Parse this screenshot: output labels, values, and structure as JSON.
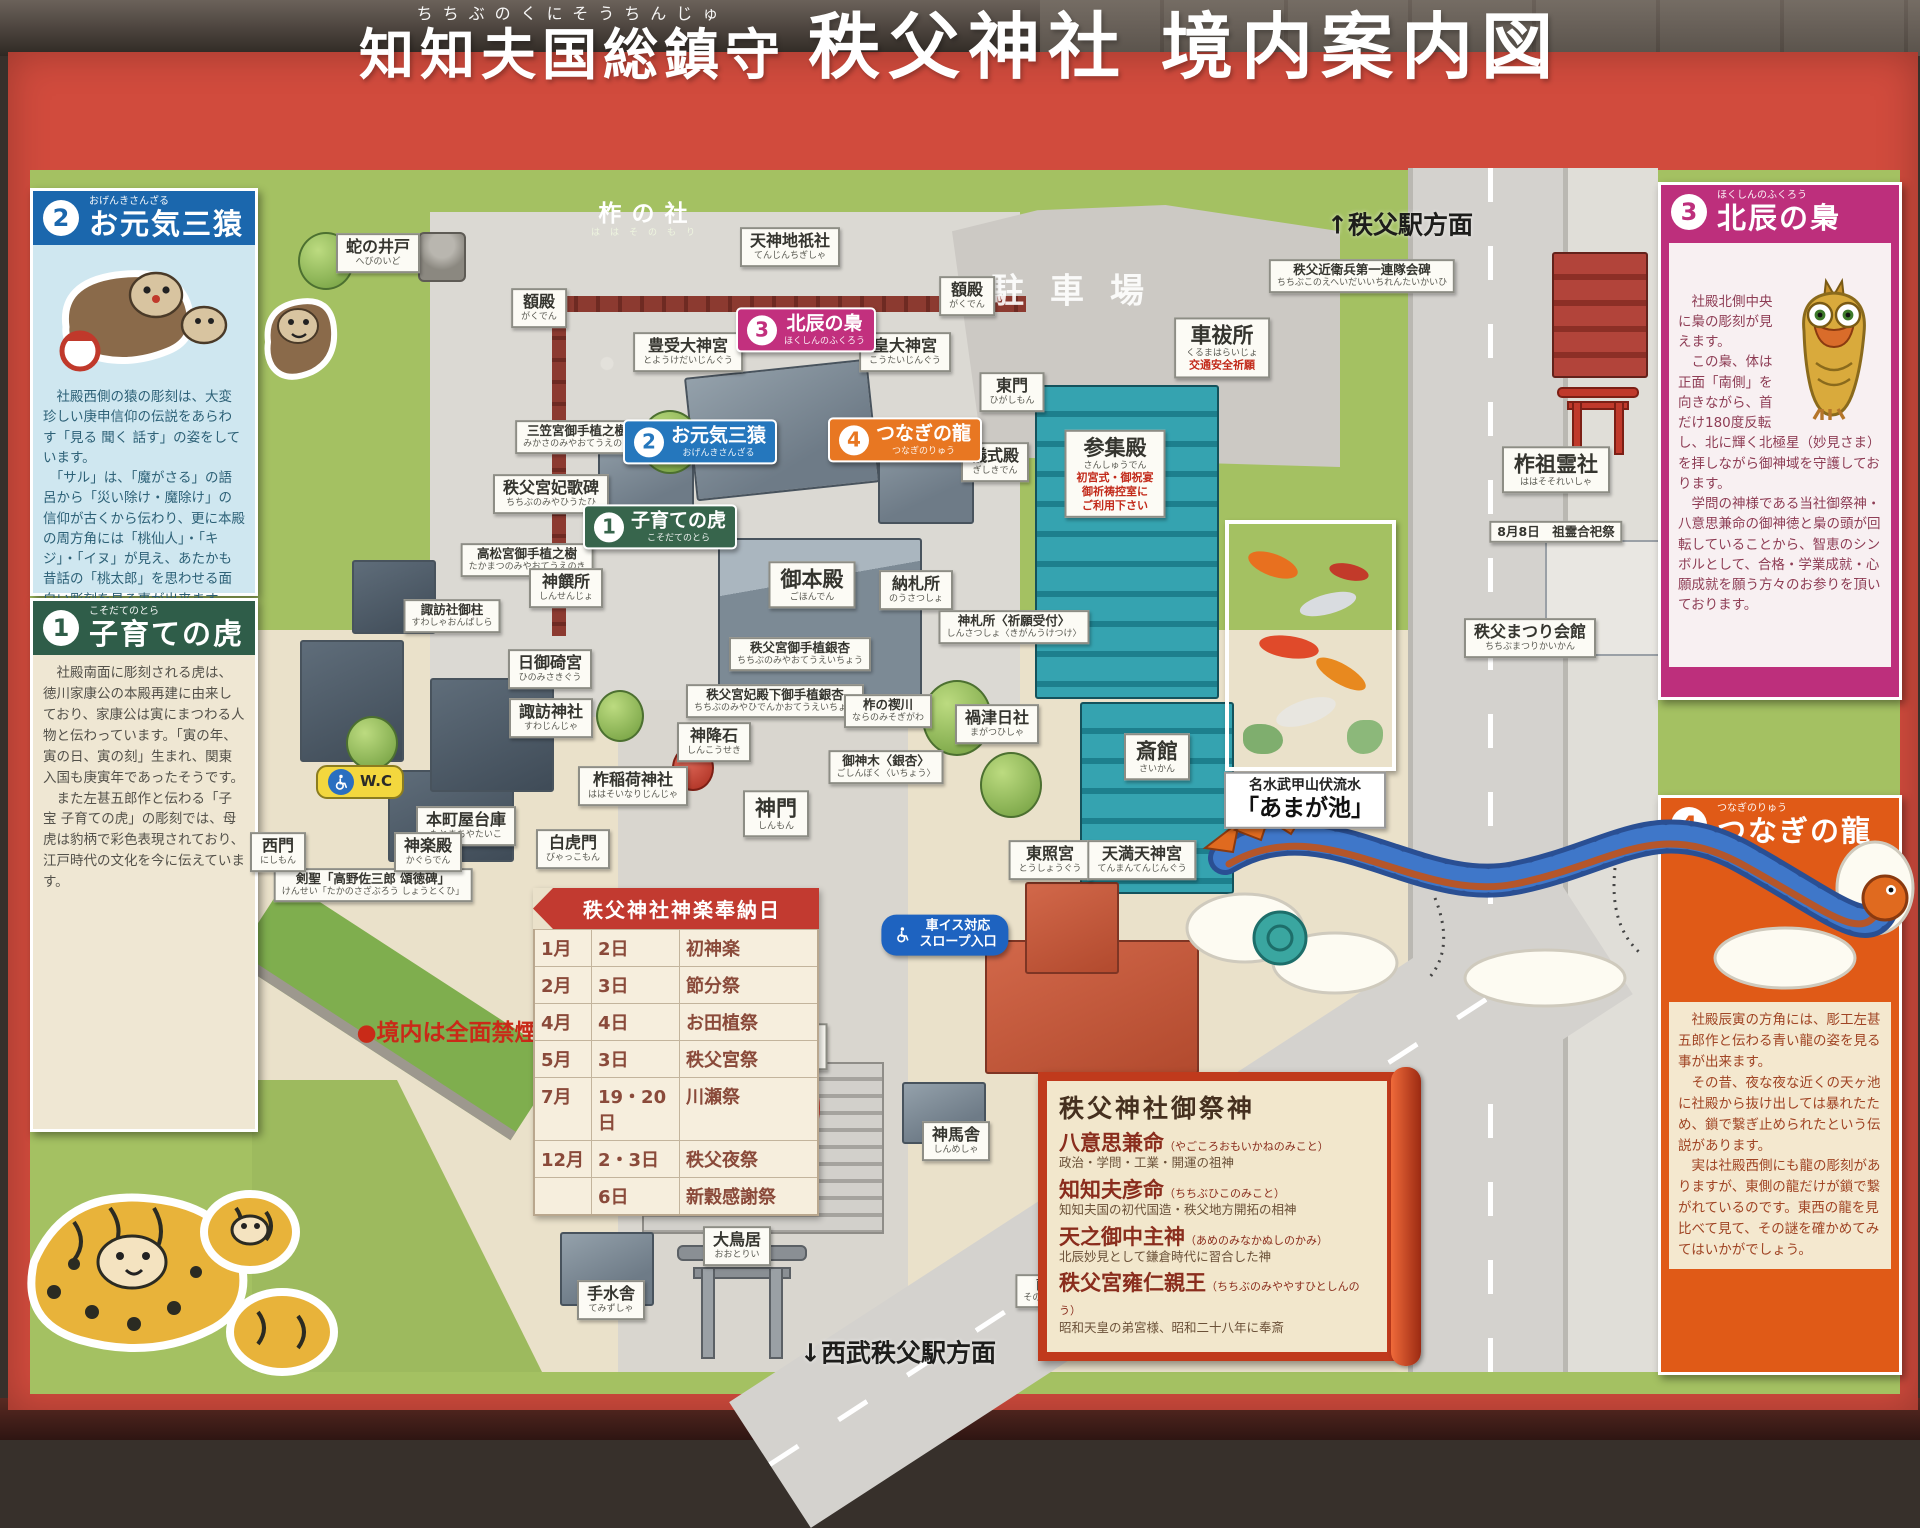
{
  "title": {
    "ruby_base": "知知夫国総鎮守",
    "ruby_text": "ちちぶのくにそうちんじゅ",
    "main": "秩父神社 境内案内図"
  },
  "panels": {
    "sanzaru": {
      "num": "2",
      "name": "お元気三猿",
      "ruby": "おげんきさんざる",
      "body": "　社殿西側の猿の彫刻は、大変珍しい庚申信仰の伝説をあらわす「見る 聞く 話す」の姿をしています。\n　「サル」は、「魔がさる」の語呂から「災い除け・魔除け」の信仰が古くから伝わり、更に本殿の周方角には「桃仙人」・「キジ」・「イヌ」が見え、あたかも昔話の「桃太郎」を思わせる面白い彫刻を見る事が出来ます。"
    },
    "tora": {
      "num": "1",
      "name": "子育ての虎",
      "ruby": "こそだてのとら",
      "body": "　社殿南面に彫刻される虎は、徳川家康公の本殿再建に由来しており、家康公は寅にまつわる人物と伝わっています。「寅の年、寅の日、寅の刻」生まれ、関東入国も庚寅年であったそうです。\n　また左甚五郎作と伝わる「子宝 子育ての虎」の彫刻では、母虎は豹柄で彩色表現されており、江戸時代の文化を今に伝えています。"
    },
    "fukurou": {
      "num": "3",
      "name": "北辰の梟",
      "ruby": "ほくしんのふくろう",
      "body": "　社殿北側中央に梟の彫刻が見えます。\n　この梟、体は正面「南側」を向きながら、首だけ180度反転し、北に輝く北極星（妙見さま）を拝しながら御神域を守護しております。\n　学問の神様である当社御祭神・八意思兼命の御神徳と梟の頭が回転していることから、智恵のシンボルとして、合格・学業成就・心願成就を願う方々のお参りを頂いております。"
    },
    "ryu": {
      "num": "4",
      "name": "つなぎの龍",
      "ruby": "つなぎのりゅう",
      "body": "　社殿辰寅の方角には、彫工左甚五郎作と伝わる青い龍の姿を見る事が出来ます。\n　その昔、夜な夜な近くの天ヶ池に社殿から抜け出しては暴れたため、鎖で繋ぎ止められたという伝説があります。\n　実は社殿西側にも龍の彫刻がありますが、東側の龍だけが鎖で繋がれているのです。東西の龍を見比べて見て、その謎を確かめてみてはいかがでしょう。"
    }
  },
  "map_labels": [
    {
      "t": "蛇の井戸",
      "s": "へびのいど",
      "x": 378,
      "y": 253,
      "type": "white"
    },
    {
      "t": "柞の社",
      "s": "ははそのもり",
      "x": 648,
      "y": 220,
      "type": "green"
    },
    {
      "t": "天神地祇社",
      "s": "てんじんちぎしゃ",
      "x": 790,
      "y": 247,
      "type": "white"
    },
    {
      "t": "額殿",
      "s": "がくでん",
      "x": 539,
      "y": 308,
      "type": "white"
    },
    {
      "t": "額殿",
      "s": "がくでん",
      "x": 967,
      "y": 296,
      "type": "white"
    },
    {
      "t": "駐車場",
      "x": 1080,
      "y": 292,
      "type": "ground"
    },
    {
      "t": "↑秩父駅方面",
      "x": 1400,
      "y": 226,
      "type": "plain"
    },
    {
      "t": "秩父近衛兵第一連隊会碑",
      "s": "ちちぶこのえへいだいいちれんたいかいひ",
      "x": 1362,
      "y": 276,
      "type": "note"
    },
    {
      "t": "車祓所",
      "s": "くるまはらいじょ",
      "x": 1222,
      "y": 348,
      "type": "bold",
      "extra": [
        "交通安全祈願"
      ]
    },
    {
      "t": "豊受大神宮",
      "s": "とようけだいじんぐう",
      "x": 688,
      "y": 352,
      "type": "white"
    },
    {
      "t": "北辰の梟",
      "s": "ほくしんのふくろう",
      "x": 806,
      "y": 330,
      "type": "badge badge-pink",
      "num": "3"
    },
    {
      "t": "皇大神宮",
      "s": "こうたいじんぐう",
      "x": 905,
      "y": 352,
      "type": "white"
    },
    {
      "t": "東門",
      "s": "ひがしもん",
      "x": 1012,
      "y": 392,
      "type": "white"
    },
    {
      "t": "お元気三猿",
      "s": "おげんきさんざる",
      "x": 700,
      "y": 442,
      "type": "badge badge-blue",
      "num": "2"
    },
    {
      "t": "つなぎの龍",
      "s": "つなぎのりゅう",
      "x": 905,
      "y": 440,
      "type": "badge badge-orange",
      "num": "4"
    },
    {
      "t": "儀式殿",
      "s": "ぎしきでん",
      "x": 995,
      "y": 462,
      "type": "white"
    },
    {
      "t": "参集殿",
      "s": "さんしゅうでん",
      "x": 1115,
      "y": 474,
      "type": "bold",
      "extra": [
        "初宮式・御祝宴",
        "御祈祷控室に",
        "ご利用下さい"
      ]
    },
    {
      "t": "三笠宮御手植之樹",
      "s": "みかさのみやおてうえのき",
      "x": 577,
      "y": 437,
      "type": "note"
    },
    {
      "t": "秩父宮妃歌碑",
      "s": "ちちぶのみやひうたひ",
      "x": 551,
      "y": 494,
      "type": "white"
    },
    {
      "t": "子育ての虎",
      "s": "こそだてのとら",
      "x": 660,
      "y": 527,
      "type": "badge badge-green",
      "num": "1"
    },
    {
      "t": "御本殿",
      "s": "ごほんでん",
      "x": 812,
      "y": 585,
      "type": "bold"
    },
    {
      "t": "納札所",
      "s": "のうさつしょ",
      "x": 916,
      "y": 590,
      "type": "white"
    },
    {
      "t": "神札所〈祈願受付〉",
      "s": "しんさつしょ〈きがんうけつけ〉",
      "x": 1014,
      "y": 627,
      "type": "note"
    },
    {
      "t": "高松宮御手植之樹",
      "s": "たかまつのみやおてうえのき",
      "x": 527,
      "y": 560,
      "type": "note"
    },
    {
      "t": "神饌所",
      "s": "しんせんじょ",
      "x": 566,
      "y": 588,
      "type": "white"
    },
    {
      "t": "諏訪社御柱",
      "s": "すわしゃおんばしら",
      "x": 452,
      "y": 616,
      "type": "note"
    },
    {
      "t": "日御碕宮",
      "s": "ひのみさきぐう",
      "x": 550,
      "y": 669,
      "type": "white"
    },
    {
      "t": "諏訪神社",
      "s": "すわじんじゃ",
      "x": 551,
      "y": 718,
      "type": "white"
    },
    {
      "t": "神降石",
      "s": "しんこうせき",
      "x": 714,
      "y": 742,
      "type": "white"
    },
    {
      "t": "柞稲荷神社",
      "s": "ははそいなりじんじゃ",
      "x": 633,
      "y": 786,
      "type": "white"
    },
    {
      "t": "秩父宮御手植銀杏",
      "s": "ちちぶのみやおてうえいちょう",
      "x": 800,
      "y": 654,
      "type": "note"
    },
    {
      "t": "秩父宮妃殿下御手植銀杏",
      "s": "ちちぶのみやひでんかおてうえいちょう",
      "x": 775,
      "y": 701,
      "type": "note"
    },
    {
      "t": "柞の禊川",
      "s": "ならのみそぎがわ",
      "x": 888,
      "y": 711,
      "type": "note"
    },
    {
      "t": "禍津日社",
      "s": "まがつひしゃ",
      "x": 997,
      "y": 724,
      "type": "white"
    },
    {
      "t": "御神木〈銀杏〉",
      "s": "ごしんぼく〈いちょう〉",
      "x": 886,
      "y": 767,
      "type": "note"
    },
    {
      "t": "神門",
      "s": "しんもん",
      "x": 776,
      "y": 814,
      "type": "bold"
    },
    {
      "t": "斎館",
      "s": "さいかん",
      "x": 1157,
      "y": 757,
      "type": "bold"
    },
    {
      "t": "名水武甲山伏流水",
      "s": "「あまが池」",
      "x": 1305,
      "y": 800,
      "type": "photocap"
    },
    {
      "t": "秩父まつり会館",
      "s": "ちちぶまつりかいかん",
      "x": 1530,
      "y": 638,
      "type": "white"
    },
    {
      "t": "柞祖霊社",
      "s": "ははそそれいしゃ",
      "x": 1556,
      "y": 470,
      "type": "bold"
    },
    {
      "t": "8月8日　祖霊合祀祭",
      "x": 1556,
      "y": 532,
      "type": "note"
    },
    {
      "t": "本町屋台庫",
      "s": "もとまちやたいこ",
      "x": 466,
      "y": 826,
      "type": "white"
    },
    {
      "t": "W.C",
      "x": 360,
      "y": 782,
      "type": "wc"
    },
    {
      "t": "白虎門",
      "s": "びゃっこもん",
      "x": 573,
      "y": 849,
      "type": "white"
    },
    {
      "t": "剣聖「高野佐三郎 頌徳碑」",
      "s": "けんせい「たかのさざぶろう しょうとくひ」",
      "x": 373,
      "y": 885,
      "type": "note"
    },
    {
      "t": "西門",
      "s": "にしもん",
      "x": 278,
      "y": 852,
      "type": "white"
    },
    {
      "t": "神楽殿",
      "s": "かぐらでん",
      "x": 428,
      "y": 852,
      "type": "white"
    },
    {
      "t": "平成殿・社務所",
      "s": "へいせいでん・しゃむしょ",
      "x": 742,
      "y": 1047,
      "type": "bold"
    },
    {
      "t": "東照宮",
      "s": "とうしょうぐう",
      "x": 1050,
      "y": 860,
      "type": "white"
    },
    {
      "t": "天満天神宮",
      "s": "てんまんてんじんぐう",
      "x": 1142,
      "y": 860,
      "type": "white"
    },
    {
      "t": "車イス対応",
      "s": "スロープ入口",
      "x": 945,
      "y": 935,
      "type": "slope"
    },
    {
      "t": "神馬舎",
      "s": "しんめしゃ",
      "x": 956,
      "y": 1141,
      "type": "white"
    },
    {
      "t": "W.C",
      "x": 1112,
      "y": 1186,
      "type": "wc"
    },
    {
      "t": "大鳥居",
      "s": "おおとりい",
      "x": 737,
      "y": 1246,
      "type": "white"
    },
    {
      "t": "手水舎",
      "s": "てみずしゃ",
      "x": 611,
      "y": 1300,
      "type": "white"
    },
    {
      "t": "薗田稲太郎頌徳碑",
      "s": "そのだいねたろうしょうとくひ",
      "x": 1086,
      "y": 1291,
      "type": "note"
    },
    {
      "t": "↓西武秩父駅方面",
      "x": 898,
      "y": 1354,
      "type": "plain"
    },
    {
      "t": "●境内は全面禁煙",
      "x": 447,
      "y": 1033,
      "type": "rednote"
    },
    {
      "t": "No smoking",
      "x": 608,
      "y": 1182,
      "type": "caption"
    },
    {
      "t": "No pets",
      "x": 747,
      "y": 1180,
      "type": "caption"
    }
  ],
  "kagura_table": {
    "title": "秩父神社神楽奉納日",
    "rows": [
      [
        "1月",
        "2日",
        "初神楽"
      ],
      [
        "2月",
        "3日",
        "節分祭"
      ],
      [
        "4月",
        "4日",
        "お田植祭"
      ],
      [
        "5月",
        "3日",
        "秩父宮祭"
      ],
      [
        "7月",
        "19・20日",
        "川瀬祭"
      ],
      [
        "12月",
        "2・3日",
        "秩父夜祭"
      ],
      [
        "",
        "6日",
        "新穀感謝祭"
      ]
    ]
  },
  "saijin": {
    "title": "秩父神社御祭神",
    "deities": [
      {
        "name": "八意思兼命",
        "ruby": "（やごころおもいかねのみこと）",
        "desc": "政治・学問・工業・開運の祖神"
      },
      {
        "name": "知知夫彦命",
        "ruby": "（ちちぶひこのみこと）",
        "desc": "知知夫国の初代国造・秩父地方開拓の相神"
      },
      {
        "name": "天之御中主神",
        "ruby": "（あめのみなかぬしのかみ）",
        "desc": "北辰妙見として鎌倉時代に習合した神"
      },
      {
        "name": "秩父宮雍仁親王",
        "ruby": "（ちちぶのみややすひとしんのう）",
        "desc": "昭和天皇の弟宮様、昭和二十八年に奉斎"
      }
    ]
  }
}
